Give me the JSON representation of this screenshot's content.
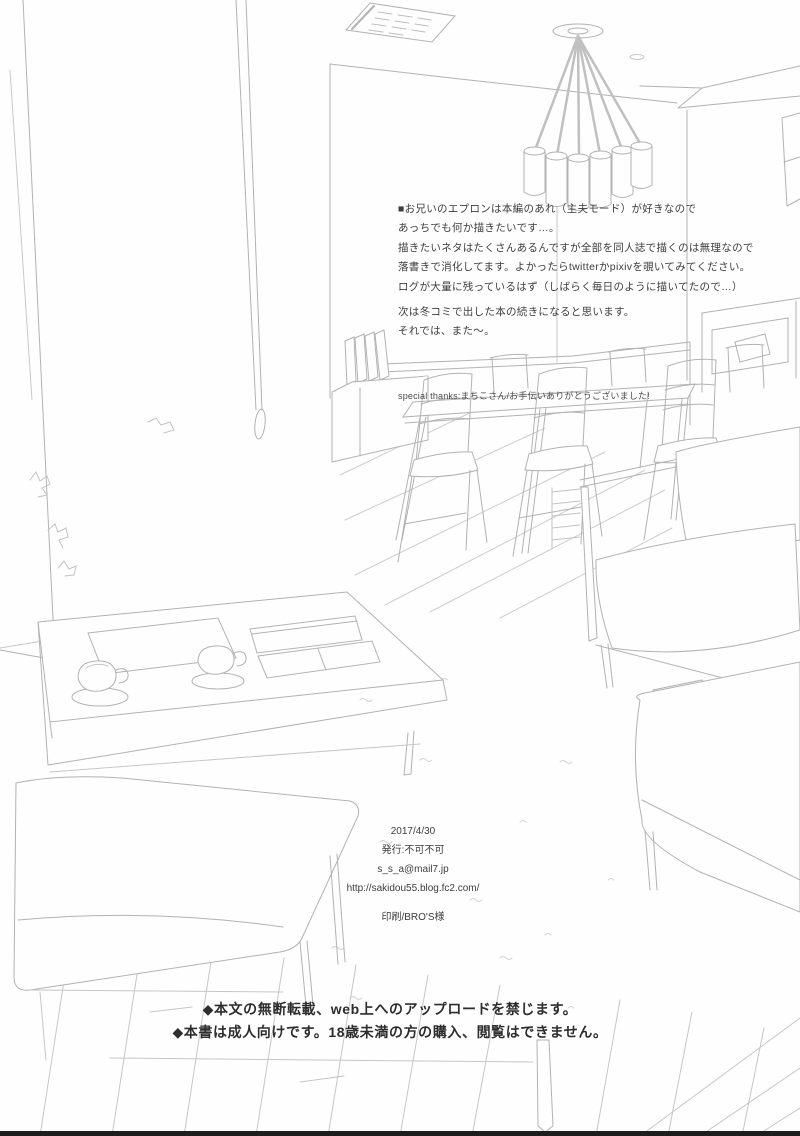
{
  "page": {
    "kind": "scanned doujinshi afterword page",
    "bg_color": "#fefefe",
    "line_art_color": "#b2b2b2",
    "text_color": "#3a3a3a",
    "bottom_edge_bar_color": "#1d1d1d"
  },
  "afterword": {
    "lines": [
      "■お兄いのエプロンは本編のあれ（主夫モード）が好きなので",
      "あっちでも何か描きたいです…。",
      "描きたいネタはたくさんあるんですが全部を同人誌で描くのは無理なので",
      "落書きで消化してます。よかったらtwitterかpixivを覗いてみてください。",
      "ログが大量に残っているはず（しばらく毎日のように描いてたので…）"
    ],
    "closing_lines": [
      "次は冬コミで出した本の続きになると思います。",
      "それでは、また〜。"
    ]
  },
  "special_thanks": "special thanks:まちこさん/お手伝いありがとうございました!",
  "colophon": {
    "date": "2017/4/30",
    "publisher": "発行:不可不可",
    "email": "s_s_a@mail7.jp",
    "url": "http://sakidou55.blog.fc2.com/",
    "printer": "印刷/BRO'S様"
  },
  "notices": [
    "◆本文の無断転載、web上へのアップロードを禁じます。",
    "◆本書は成人向けです。18歳未満の方の購入、閲覧はできません。"
  ],
  "scene": {
    "description": "pencil line-art of a living/dining room interior",
    "objects": [
      "ceiling-vent",
      "pendant-chandelier",
      "hanging-cord",
      "left-wall",
      "wall-corner",
      "wall-cabinet",
      "sideboard-with-books",
      "dining-table",
      "dining-chairs",
      "half-wall",
      "wood-frame-sofa",
      "seat-cushions",
      "coffee-table",
      "teacup-and-saucer",
      "teacup-and-saucer",
      "tray",
      "box",
      "open-book",
      "ottoman",
      "corner-sofa",
      "wood-plank-floor",
      "rug",
      "plant-sprigs"
    ]
  }
}
